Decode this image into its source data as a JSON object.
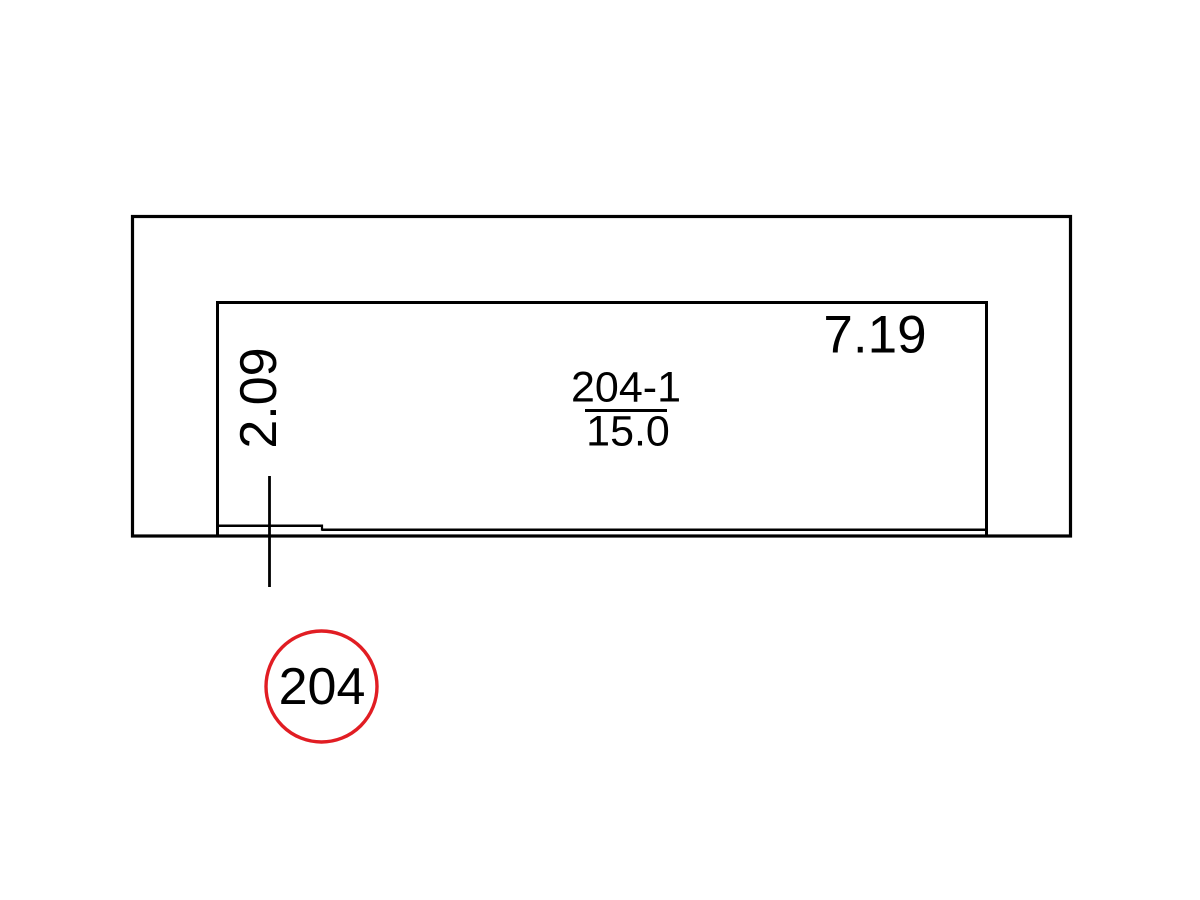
{
  "plan": {
    "dimension_width": "7.19",
    "dimension_height": "2.09",
    "room_id": "204-1",
    "room_area": "15.0",
    "room_tag": "204"
  },
  "colors": {
    "line": "#000000",
    "tag_circle": "#e11d23",
    "background": "#ffffff"
  }
}
